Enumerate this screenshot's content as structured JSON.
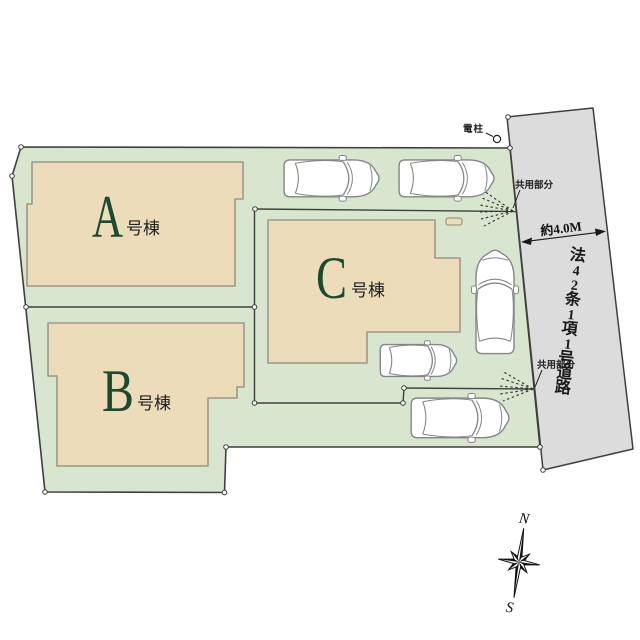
{
  "plan": {
    "buildings": [
      {
        "letter": "A",
        "suffix": "号棟"
      },
      {
        "letter": "B",
        "suffix": "号棟"
      },
      {
        "letter": "C",
        "suffix": "号棟"
      }
    ],
    "annotations": {
      "utility_pole": "電柱",
      "shared_area_1": "共用部分",
      "shared_area_2": "共用部分",
      "road_width": "約4.0M"
    },
    "road": {
      "name": "法42条1項1号道路",
      "chars": [
        "法",
        "4",
        "2",
        "条",
        "1",
        "項",
        "1",
        "号",
        "道",
        "路"
      ]
    },
    "compass": {
      "north": "N",
      "south": "S"
    },
    "counts": {
      "cars": 5
    },
    "colors": {
      "site_green": "#d8e5cf",
      "building_beige": "#ecdcba",
      "road_gray": "#dcdcdc",
      "label_green": "#1c4a2e",
      "line_dark": "#3f3f3f",
      "car_outline": "#858585"
    }
  }
}
